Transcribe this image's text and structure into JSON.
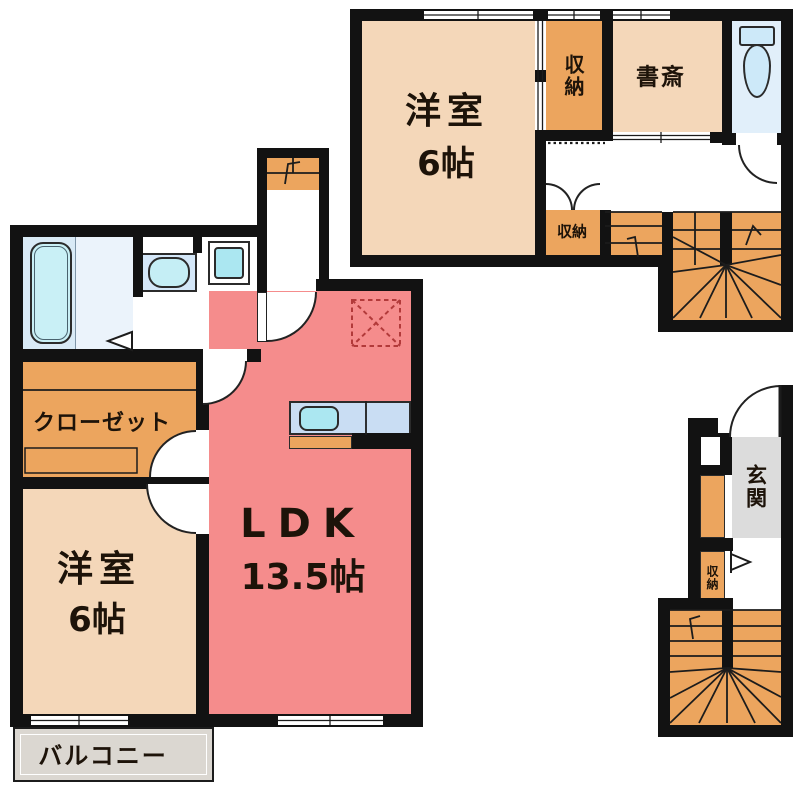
{
  "floorplan": {
    "upper_floor": {
      "bedroom": {
        "label": "洋室",
        "size": "6帖"
      },
      "storage": {
        "label": "収納"
      },
      "study": {
        "label": "書斎"
      },
      "storage_small": {
        "label": "収納"
      }
    },
    "main_floor": {
      "closet": {
        "label": "クローゼット"
      },
      "bedroom": {
        "label": "洋室",
        "size": "6帖"
      },
      "ldk": {
        "label": "LDK",
        "size": "13.5帖"
      },
      "balcony": {
        "label": "バルコニー"
      }
    },
    "entrance_floor": {
      "entrance": {
        "label": "玄関"
      },
      "storage": {
        "label": "収納"
      }
    },
    "colors": {
      "wall": "#121212",
      "room_peach": "#F4D7B9",
      "room_pink": "#F58C8C",
      "storage_orange": "#ECA55E",
      "bath_floor": "#D9EAF6",
      "bath_panel": "#EBF3FB",
      "tub_blue": "#C9F0F6",
      "water_blue": "#ABE7F1",
      "toilet_room": "#E1EFFA",
      "toilet_fixture": "#CDE9F9",
      "counter_blue": "#C9DDF3",
      "entrance_gray": "#DCDCDC",
      "balcony_gray": "#DBD7D1",
      "dashed_red": "#B23A3A"
    },
    "fixtures": {
      "bathtub": "bathtub-icon",
      "washbasin": "washbasin-icon",
      "washing_machine": "washing-machine-icon",
      "toilet": "toilet-icon",
      "kitchen_sink": "kitchen-sink-icon",
      "staircase": "stairs-icon",
      "refrigerator_space": "dashed-box-icon",
      "door": "door-arc-icon"
    }
  }
}
